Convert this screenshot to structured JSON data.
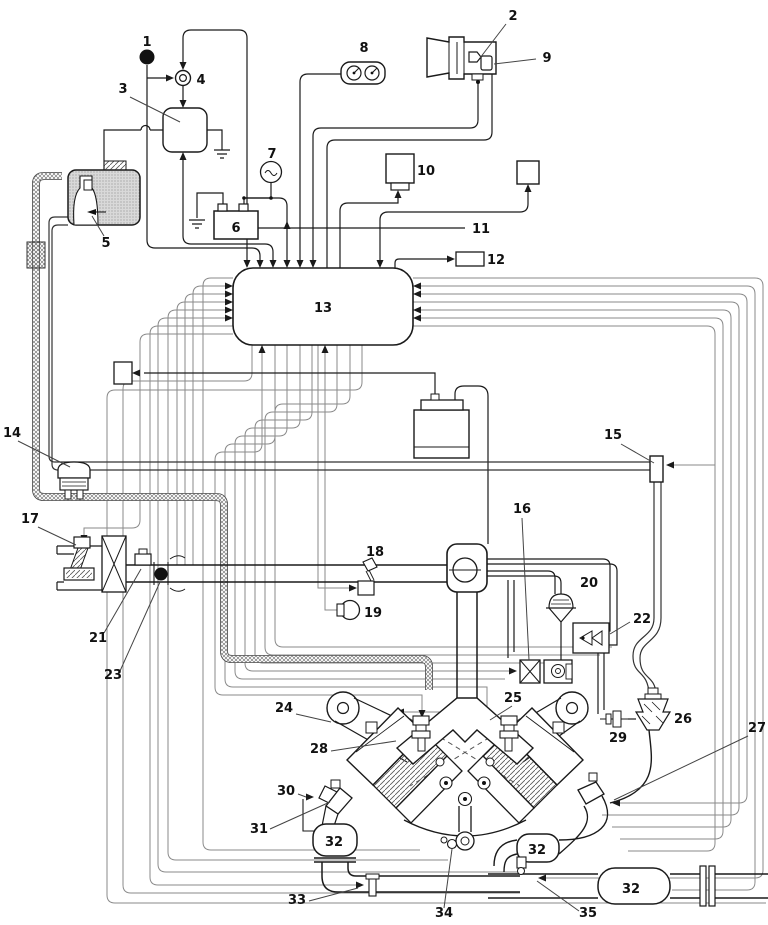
{
  "diagram": {
    "type": "engine-management-vacuum-and-wiring-schematic",
    "background": "#ffffff",
    "line_color": "#1a1a1a",
    "wire_color": "#8a8a8a",
    "labels": [
      {
        "key": "1",
        "text": "1",
        "x": 147,
        "y": 46
      },
      {
        "key": "2",
        "text": "2",
        "x": 513,
        "y": 20
      },
      {
        "key": "3",
        "text": "3",
        "x": 123,
        "y": 93
      },
      {
        "key": "4",
        "text": "4",
        "x": 201,
        "y": 84
      },
      {
        "key": "5",
        "text": "5",
        "x": 106,
        "y": 247
      },
      {
        "key": "6",
        "text": "6",
        "x": 236,
        "y": 232
      },
      {
        "key": "7",
        "text": "7",
        "x": 272,
        "y": 158
      },
      {
        "key": "8",
        "text": "8",
        "x": 364,
        "y": 52
      },
      {
        "key": "9",
        "text": "9",
        "x": 547,
        "y": 62
      },
      {
        "key": "10",
        "text": "10",
        "x": 426,
        "y": 175
      },
      {
        "key": "11",
        "text": "11",
        "x": 481,
        "y": 233
      },
      {
        "key": "12",
        "text": "12",
        "x": 496,
        "y": 264
      },
      {
        "key": "13",
        "text": "13",
        "x": 323,
        "y": 312
      },
      {
        "key": "14",
        "text": "14",
        "x": 12,
        "y": 437
      },
      {
        "key": "15",
        "text": "15",
        "x": 613,
        "y": 439
      },
      {
        "key": "16",
        "text": "16",
        "x": 522,
        "y": 513
      },
      {
        "key": "17",
        "text": "17",
        "x": 30,
        "y": 523
      },
      {
        "key": "18",
        "text": "18",
        "x": 375,
        "y": 556
      },
      {
        "key": "19",
        "text": "19",
        "x": 373,
        "y": 617
      },
      {
        "key": "20",
        "text": "20",
        "x": 589,
        "y": 587
      },
      {
        "key": "21",
        "text": "21",
        "x": 98,
        "y": 642
      },
      {
        "key": "22",
        "text": "22",
        "x": 642,
        "y": 623
      },
      {
        "key": "23",
        "text": "23",
        "x": 113,
        "y": 679
      },
      {
        "key": "24",
        "text": "24",
        "x": 284,
        "y": 712
      },
      {
        "key": "25",
        "text": "25",
        "x": 513,
        "y": 702
      },
      {
        "key": "26",
        "text": "26",
        "x": 683,
        "y": 723
      },
      {
        "key": "27",
        "text": "27",
        "x": 757,
        "y": 732
      },
      {
        "key": "28",
        "text": "28",
        "x": 319,
        "y": 753
      },
      {
        "key": "29",
        "text": "29",
        "x": 618,
        "y": 742
      },
      {
        "key": "30",
        "text": "30",
        "x": 286,
        "y": 795
      },
      {
        "key": "31",
        "text": "31",
        "x": 259,
        "y": 833
      },
      {
        "key": "32a",
        "text": "32",
        "x": 334,
        "y": 846
      },
      {
        "key": "32b",
        "text": "32",
        "x": 537,
        "y": 854
      },
      {
        "key": "32c",
        "text": "32",
        "x": 631,
        "y": 893
      },
      {
        "key": "33",
        "text": "33",
        "x": 297,
        "y": 904
      },
      {
        "key": "34",
        "text": "34",
        "x": 444,
        "y": 917
      },
      {
        "key": "35",
        "text": "35",
        "x": 588,
        "y": 917
      }
    ]
  }
}
